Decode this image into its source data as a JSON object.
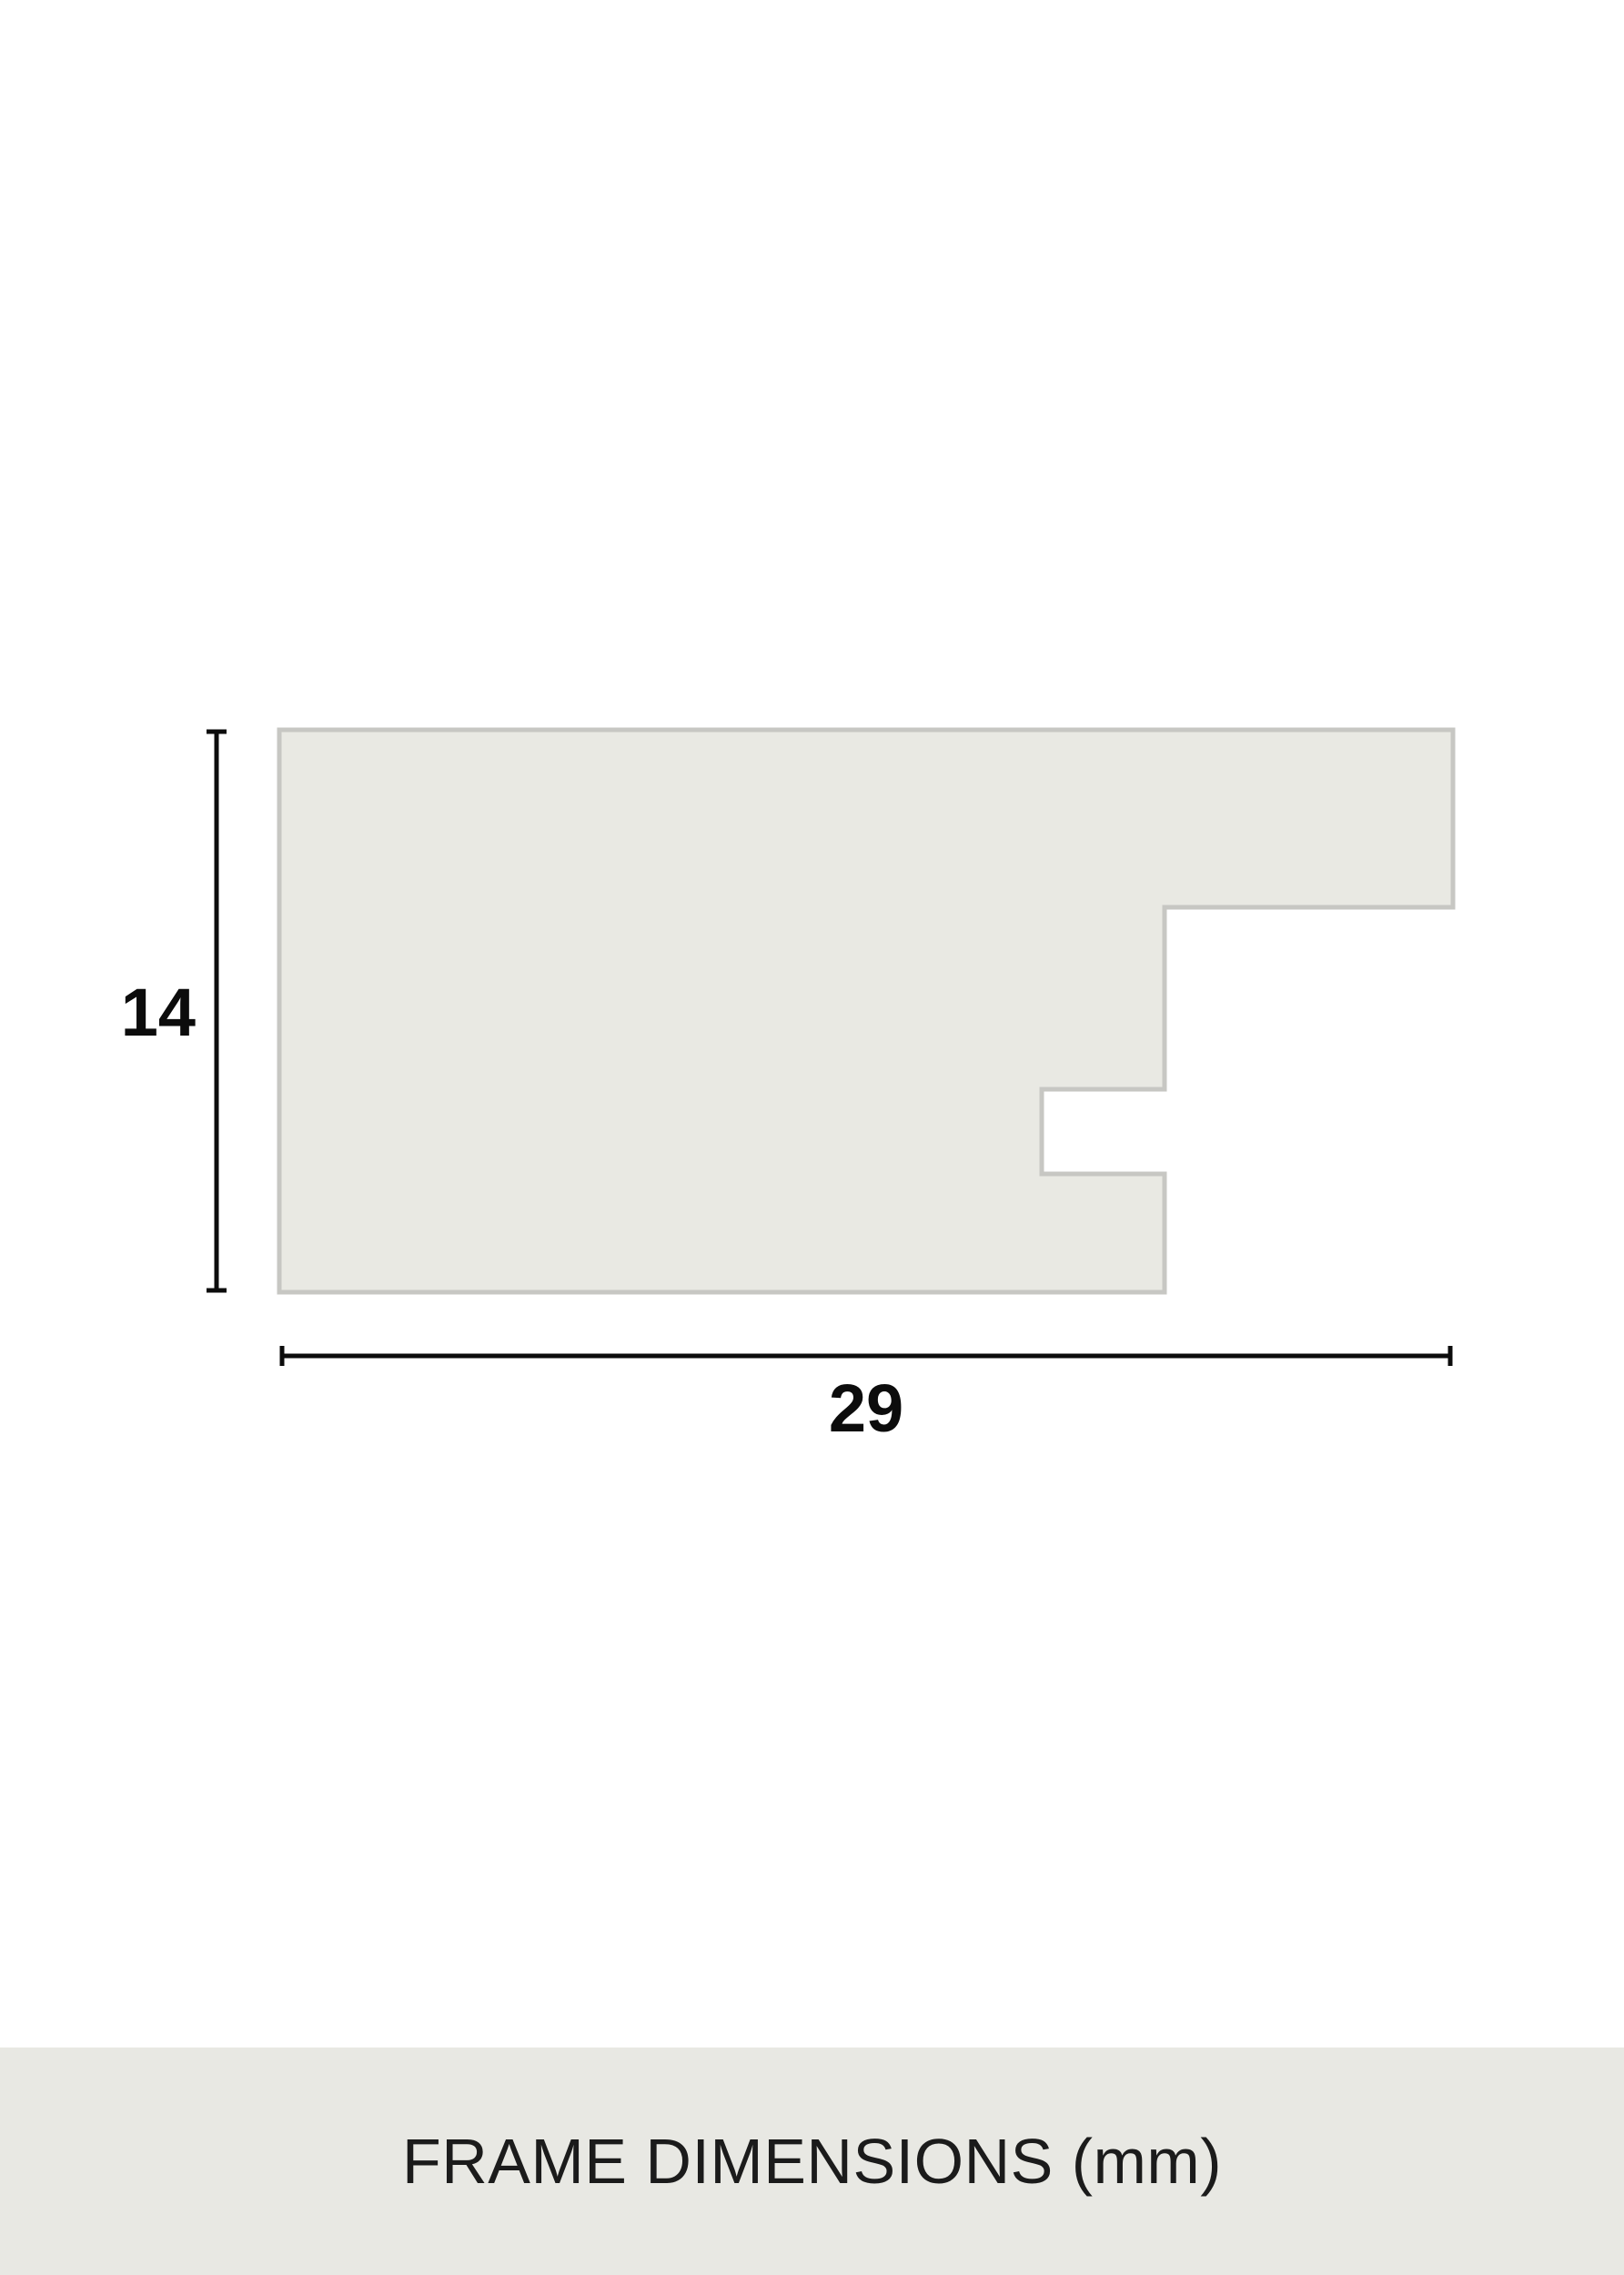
{
  "diagram": {
    "height_dimension": {
      "label": "14"
    },
    "width_dimension": {
      "label": "29"
    }
  },
  "footer": {
    "title": "FRAME DIMENSIONS (mm)"
  },
  "theme": {
    "page_bg": "#ffffff",
    "shape_fill": "#e9e9e3",
    "shape_stroke": "#c7c7c3",
    "dim_color": "#0c0c0c",
    "footer_bg": "#e8e8e3",
    "footer_text": "#1b1b1b"
  }
}
